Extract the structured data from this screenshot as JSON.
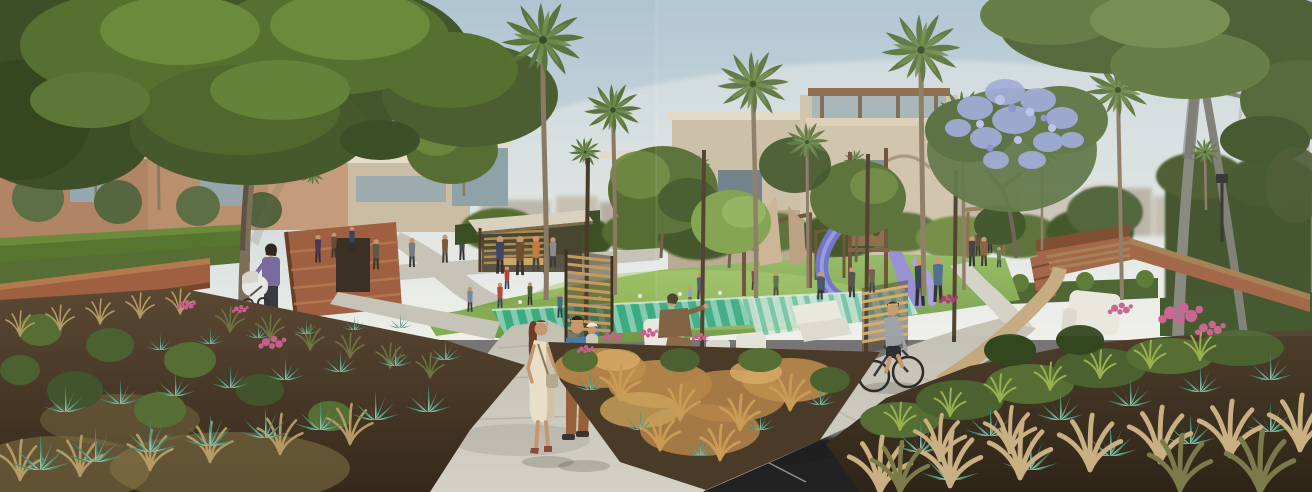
{
  "meta": {
    "description": "Sunlit architectural rendering of a landscaped residential park promenade: tan and terracotta villas behind fan palms, a large shade tree on each side, a lavender-blossom tree, a central lawn with a wooden playground and blue tube slide, a teal striped splash pad with white lounge chairs, curving concrete walkways with pedestrians, a stroller, a cyclist, brick terraced walls and steps, and dense foreground beds of teal agave, ornamental grasses and pink flowers.",
    "width": 1312,
    "height": 492
  },
  "scene": {
    "setting": "daytime, hazy pale sky, warm sunlight from the left",
    "elements": [
      {
        "name": "sky",
        "label": "Pale hazy blue sky"
      },
      {
        "name": "left-villas",
        "label": "Terracotta and beige villas, left"
      },
      {
        "name": "center-villa",
        "label": "Beige villa with rooftop pergola, center"
      },
      {
        "name": "right-white-building",
        "label": "Curved white building, right edge"
      },
      {
        "name": "distant-skyline",
        "label": "Hazy distant townhouses"
      },
      {
        "name": "palm-grove",
        "label": "Tall fan palms"
      },
      {
        "name": "left-shade-tree",
        "label": "Large shade tree, left foreground"
      },
      {
        "name": "right-shade-tree",
        "label": "Tall twin-trunk tree, right foreground"
      },
      {
        "name": "blossom-tree",
        "label": "Lavender flowering tree"
      },
      {
        "name": "lawn",
        "label": "Sunlit central lawn"
      },
      {
        "name": "playground",
        "label": "Wooden playground with blue and purple slides"
      },
      {
        "name": "pavilion",
        "label": "Flat-roof timber pavilion"
      },
      {
        "name": "splash-pad",
        "label": "Teal striped splash pad"
      },
      {
        "name": "seating-area",
        "label": "White outdoor lounge chairs"
      },
      {
        "name": "walkways",
        "label": "Curving concrete walkways"
      },
      {
        "name": "brick-terraces",
        "label": "Brick terraced walls and amphitheater steps"
      },
      {
        "name": "brick-bench",
        "label": "Brick stair bench, right"
      },
      {
        "name": "garden-bed-left",
        "label": "Foreground bed: agave, grasses, pink flowers"
      },
      {
        "name": "garden-bed-center",
        "label": "Amber ornamental grass bed"
      },
      {
        "name": "garden-bed-right",
        "label": "Foreground bed with wheat grasses and agave"
      },
      {
        "name": "pedestrians",
        "label": "People strolling, couple carrying child"
      },
      {
        "name": "stroller",
        "label": "Parent pushing white stroller"
      },
      {
        "name": "cyclist",
        "label": "Cyclist on the right walkway"
      },
      {
        "name": "bollard-light",
        "label": "Path bollard light"
      },
      {
        "name": "lamp-post",
        "label": "Garden lamp post"
      }
    ]
  },
  "palette": {
    "skyTop": "#afc4d2",
    "skyMid": "#ccd8da",
    "skyHorizon": "#edefe8",
    "terracotta": "#b08465",
    "terracottaDark": "#8f6144",
    "beige": "#cbbda4",
    "beigeShade": "#b2a28a",
    "whiteBldg": "#dcdad1",
    "glass": "#93a8b0",
    "lawn": "#86ad52",
    "hedge": "#455f2b",
    "hedgeLight": "#57752f",
    "foliageDark": "#3c5124",
    "foliageMid": "#566d33",
    "foliageLight": "#6f8a40",
    "palmFrond": "#5a7440",
    "palmFrondLight": "#708c4a",
    "trunkBrown": "#7d6e5a",
    "trunkGrey": "#83857a",
    "wood": "#a47c4f",
    "brick": "#9e6040",
    "brickDark": "#7a4729",
    "brickCap": "#b5794f",
    "path": "#c6c3b8",
    "gravel": "#c2a87c",
    "soil": "#51402c",
    "splashTeal": "#3cab81",
    "splashPale": "#cfe6d8",
    "agave": "#4c8d76",
    "agaveLight": "#8fc3aa",
    "grassTan": "#b49a64",
    "grassAmber": "#c08f4e",
    "flowerPink": "#c75f8c",
    "lavender": "#9ea9d8",
    "slideBlue": "#6b70c5",
    "slidePurple": "#958bd2",
    "chairWhite": "#e9e7dd",
    "skin": "#c6976f",
    "shirtBlue": "#4a7aa8",
    "pantsRust": "#96613a",
    "dressCream": "#e9dfc9",
    "hairAuburn": "#6e3d28"
  }
}
